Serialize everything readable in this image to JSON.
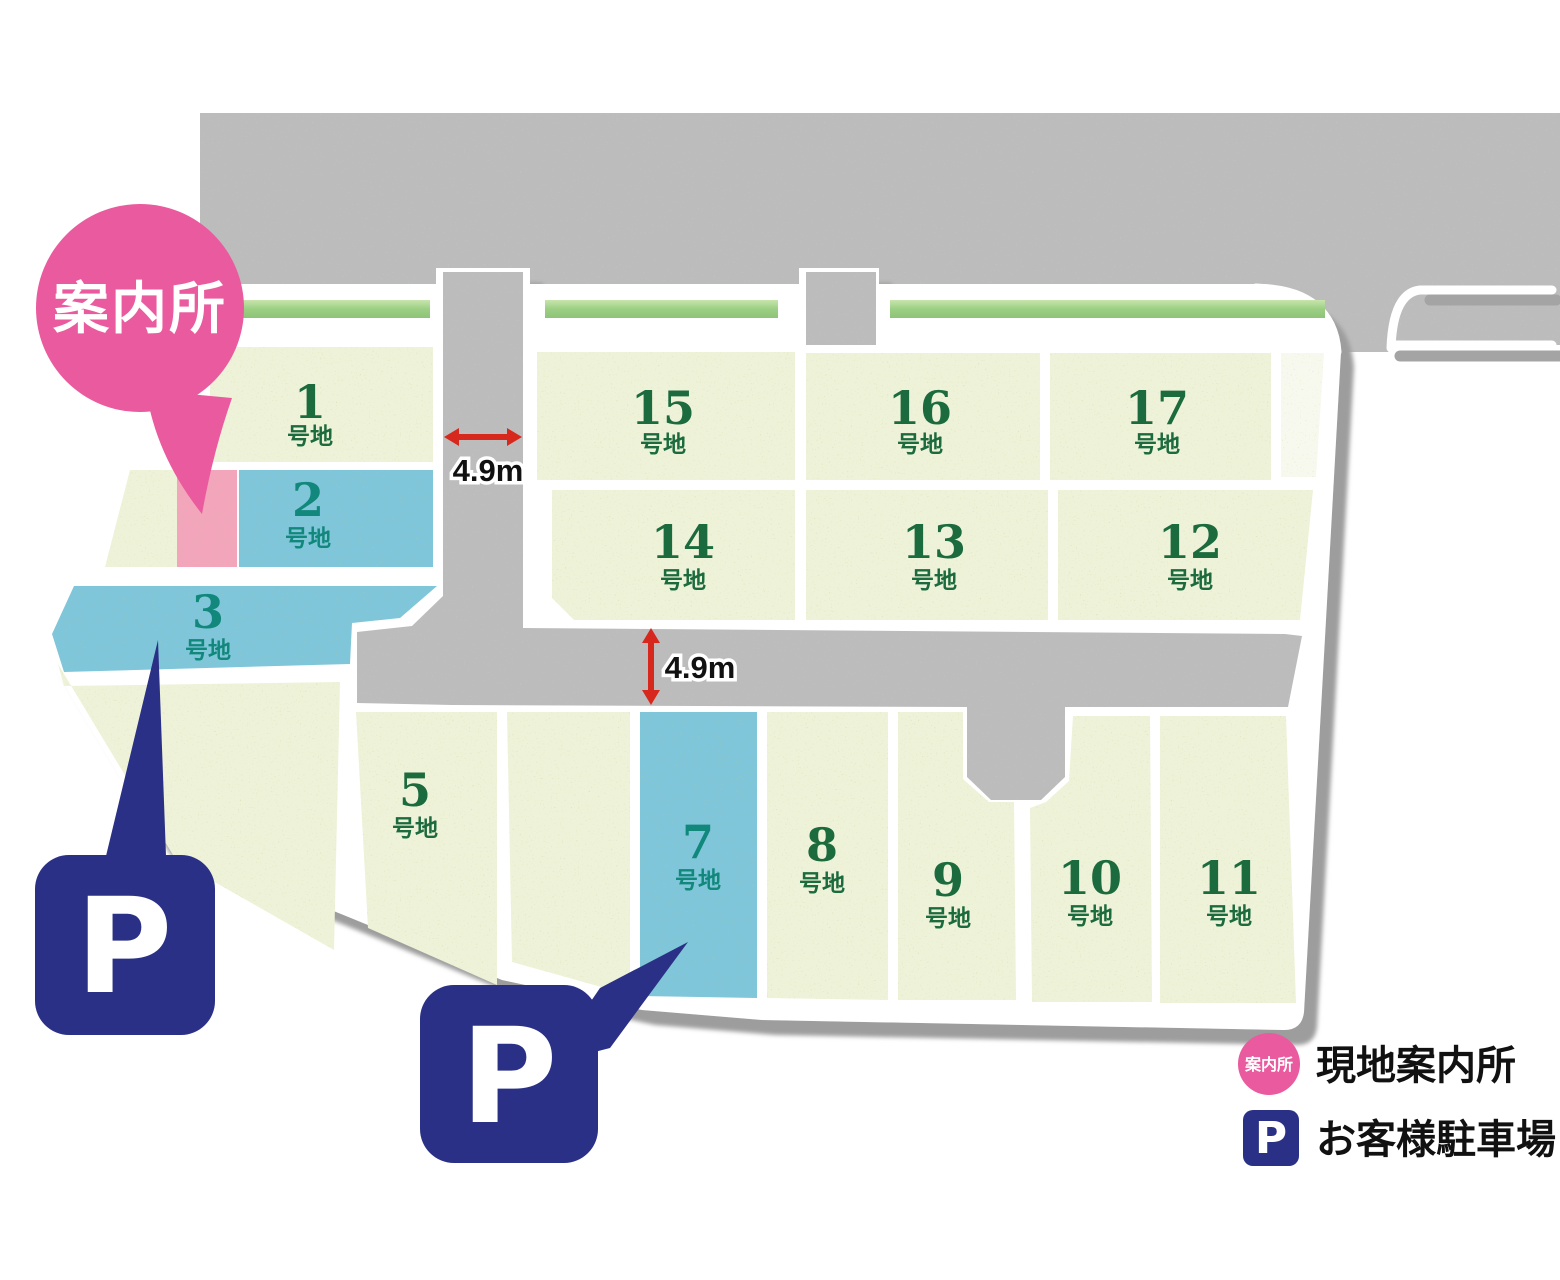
{
  "map": {
    "balloon": {
      "label": "案内所"
    },
    "road_annotations": [
      {
        "text": "4.9m"
      },
      {
        "text": "4.9m"
      }
    ],
    "parking_markers": [
      {
        "symbol": "P"
      },
      {
        "symbol": "P"
      }
    ],
    "lots": [
      {
        "number": "1",
        "suffix": "号地",
        "state": "available"
      },
      {
        "number": "2",
        "suffix": "号地",
        "state": "highlighted"
      },
      {
        "number": "3",
        "suffix": "号地",
        "state": "highlighted"
      },
      {
        "number": "5",
        "suffix": "号地",
        "state": "available"
      },
      {
        "number": "7",
        "suffix": "号地",
        "state": "highlighted"
      },
      {
        "number": "8",
        "suffix": "号地",
        "state": "available"
      },
      {
        "number": "9",
        "suffix": "号地",
        "state": "available"
      },
      {
        "number": "10",
        "suffix": "号地",
        "state": "available"
      },
      {
        "number": "11",
        "suffix": "号地",
        "state": "available"
      },
      {
        "number": "12",
        "suffix": "号地",
        "state": "available"
      },
      {
        "number": "13",
        "suffix": "号地",
        "state": "available"
      },
      {
        "number": "14",
        "suffix": "号地",
        "state": "available"
      },
      {
        "number": "15",
        "suffix": "号地",
        "state": "available"
      },
      {
        "number": "16",
        "suffix": "号地",
        "state": "available"
      },
      {
        "number": "17",
        "suffix": "号地",
        "state": "available"
      }
    ]
  },
  "legend": {
    "office_badge": "案内所",
    "office_label": "現地案内所",
    "parking_badge": "P",
    "parking_label": "お客様駐車場"
  },
  "colors": {
    "road": "#bcbcbc",
    "lot": "#eef2d8",
    "lot_highlight": "#7fc6da",
    "office_strip": "#f2a5bb",
    "accent_pink": "#ea5a9e",
    "parking_navy": "#2a3085",
    "arrow_red": "#d7281e",
    "label_green": "#1c6b3e",
    "label_teal": "#12877b"
  }
}
